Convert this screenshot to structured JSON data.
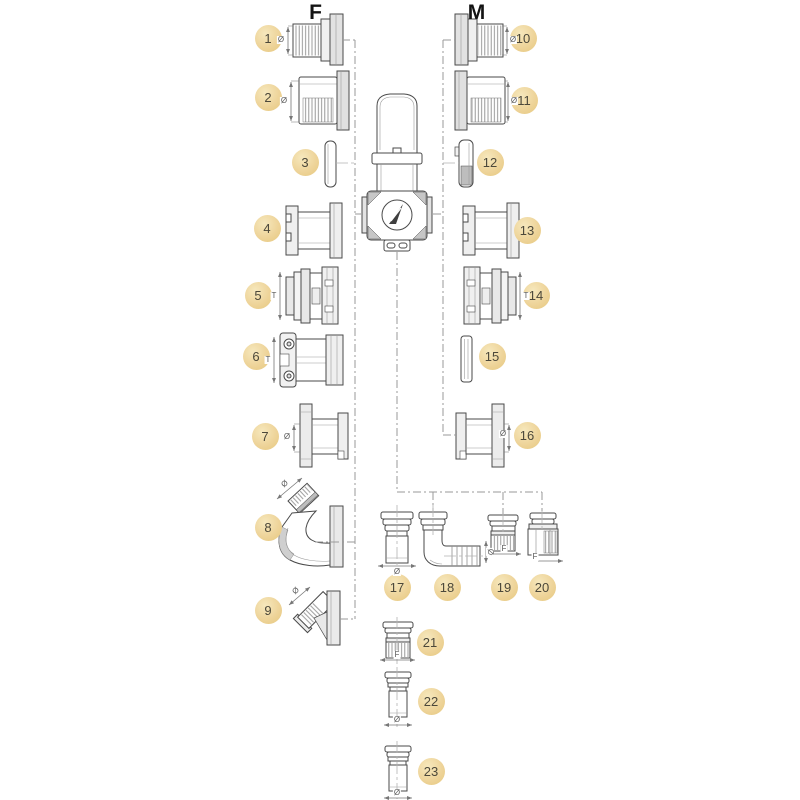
{
  "diagram": {
    "title_female": "F",
    "title_male": "M",
    "callouts": [
      "1",
      "2",
      "3",
      "4",
      "5",
      "6",
      "7",
      "8",
      "9",
      "10",
      "11",
      "12",
      "13",
      "14",
      "15",
      "16",
      "17",
      "18",
      "19",
      "20",
      "21",
      "22",
      "23"
    ],
    "symbols": {
      "diameter": "Ø",
      "female_thread": "F",
      "thread_length": "T"
    },
    "colors": {
      "callout_fill": "#EED49A",
      "callout_text": "#4C483A",
      "line_art": "#4A4A4A",
      "dash_line": "#9A9A9A",
      "dimension": "#777777",
      "background": "#FFFFFF"
    }
  }
}
